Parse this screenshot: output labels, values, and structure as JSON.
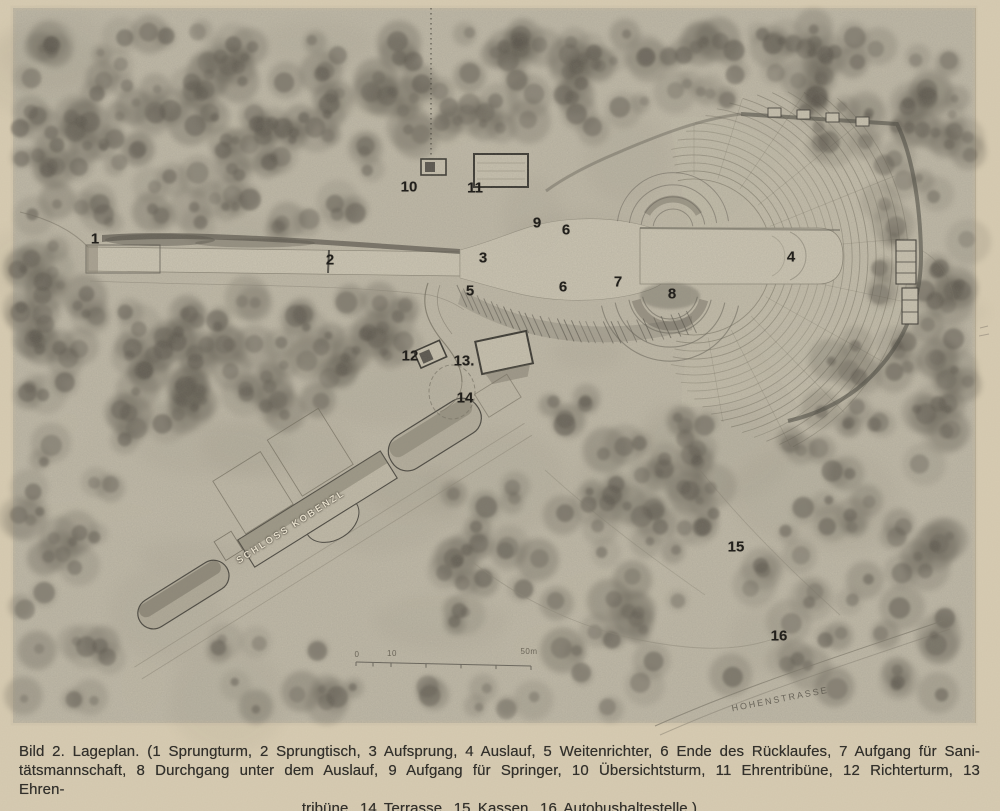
{
  "caption": {
    "lines": [
      "Bild 2. Lageplan. (1 Sprungturm, 2 Sprungtisch, 3 Aufsprung, 4 Auslauf, 5 Weitenrichter, 6 Ende des Rücklaufes, 7 Aufgang für Sani-",
      "tätsmannschaft, 8 Durchgang unter dem Auslauf, 9 Aufgang für Springer, 10 Übersichtsturm, 11 Ehrentribüne, 12 Richterturm, 13 Ehren-",
      "tribüne, 14 Terrasse, 15 Kassen, 16 Autobushaltestelle.)"
    ]
  },
  "plan": {
    "markers": [
      "1",
      "2",
      "3",
      "4",
      "5",
      "6",
      "6",
      "7",
      "8",
      "9",
      "10",
      "11",
      "12",
      "13.",
      "14",
      "15",
      "16"
    ],
    "place_labels": {
      "schloss": "SCHLOSS KOBENZL",
      "street": "HOHENSTRASSE"
    },
    "scale_bar": {
      "labels": [
        "0",
        "10",
        "50m"
      ]
    }
  },
  "colors": {
    "paper": "#d9cdb3",
    "plate": "#c6bfad",
    "ink": "#32302b"
  }
}
